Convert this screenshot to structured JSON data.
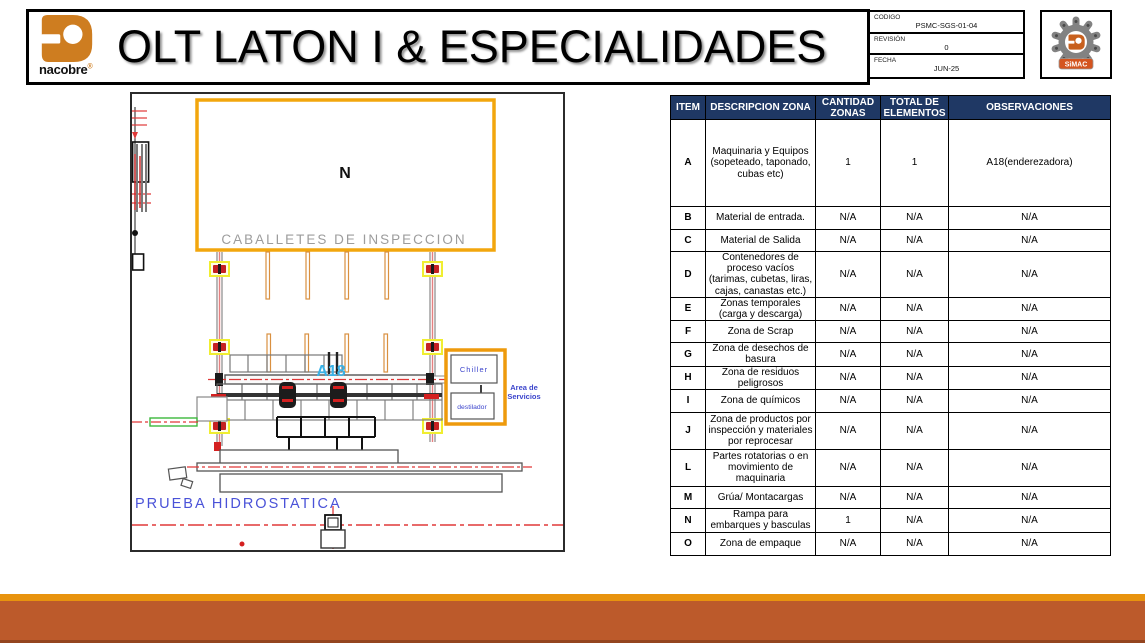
{
  "header": {
    "title": "OLT LATON I & ESPECIALIDADES",
    "brand": {
      "name": "nacobre",
      "mark": "®"
    },
    "code_table": {
      "rows": [
        {
          "label": "CODIGO",
          "value": "PSMC-SGS-01-04"
        },
        {
          "label": "REVISIÓN",
          "value": "0"
        },
        {
          "label": "FECHA",
          "value": "JUN-25"
        }
      ]
    },
    "simac": {
      "label": "SiMAC"
    }
  },
  "drawing": {
    "north_label": "N",
    "caballetes_label": "CABALLETES DE INSPECCION",
    "machine_label": "A18",
    "chiller_label": "Chiller",
    "destilador_label": "destilador",
    "area_servicios_line1": "Area de",
    "area_servicios_line2": "Servicios",
    "prueba_label": "PRUEBA HIDROSTATICA"
  },
  "zones_table": {
    "headers": [
      "ITEM",
      "DESCRIPCION ZONA",
      "CANTIDAD ZONAS",
      "TOTAL DE ELEMENTOS",
      "OBSERVACIONES"
    ],
    "rows": [
      {
        "item": "A",
        "desc": "Maquinaria y Equipos (sopeteado, taponado, cubas etc)",
        "cant": "1",
        "total": "1",
        "obs": "A18(enderezadora)"
      },
      {
        "item": "B",
        "desc": "Material de entrada.",
        "cant": "N/A",
        "total": "N/A",
        "obs": "N/A"
      },
      {
        "item": "C",
        "desc": "Material de Salida",
        "cant": "N/A",
        "total": "N/A",
        "obs": "N/A"
      },
      {
        "item": "D",
        "desc": "Contenedores de proceso vacíos (tarimas, cubetas, liras, cajas, canastas etc.)",
        "cant": "N/A",
        "total": "N/A",
        "obs": "N/A"
      },
      {
        "item": "E",
        "desc": "Zonas temporales (carga y descarga)",
        "cant": "N/A",
        "total": "N/A",
        "obs": "N/A"
      },
      {
        "item": "F",
        "desc": "Zona de Scrap",
        "cant": "N/A",
        "total": "N/A",
        "obs": "N/A"
      },
      {
        "item": "G",
        "desc": "Zona de desechos de basura",
        "cant": "N/A",
        "total": "N/A",
        "obs": "N/A"
      },
      {
        "item": "H",
        "desc": "Zona de residuos peligrosos",
        "cant": "N/A",
        "total": "N/A",
        "obs": "N/A"
      },
      {
        "item": "I",
        "desc": "Zona de químicos",
        "cant": "N/A",
        "total": "N/A",
        "obs": "N/A"
      },
      {
        "item": "J",
        "desc": "Zona de productos por inspección y materiales por reprocesar",
        "cant": "N/A",
        "total": "N/A",
        "obs": "N/A"
      },
      {
        "item": "L",
        "desc": "Partes rotatorias o en movimiento de maquinaria",
        "cant": "N/A",
        "total": "N/A",
        "obs": "N/A"
      },
      {
        "item": "M",
        "desc": "Grúa/ Montacargas",
        "cant": "N/A",
        "total": "N/A",
        "obs": "N/A"
      },
      {
        "item": "N",
        "desc": "Rampa para embarques y basculas",
        "cant": "1",
        "total": "N/A",
        "obs": "N/A"
      },
      {
        "item": "O",
        "desc": "Zona de empaque",
        "cant": "N/A",
        "total": "N/A",
        "obs": "N/A"
      }
    ]
  },
  "colors": {
    "table_header_navy": "#1F3864",
    "brand_orange": "#CE7D20",
    "cad_orange": "#F2A60D",
    "cad_blue": "#4048D0",
    "cad_cyan": "#38B2E8",
    "cad_red": "#E03838",
    "footer_strip_orange": "#E8930E",
    "footer_block_rust": "#BC5A2B"
  }
}
